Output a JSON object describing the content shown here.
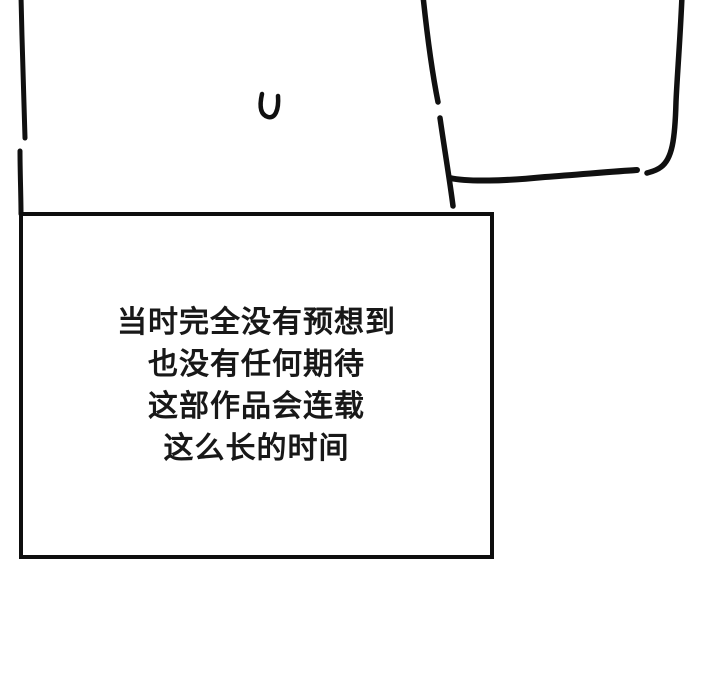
{
  "page": {
    "background_color": "#ffffff",
    "ink_color": "#101010"
  },
  "caption_box": {
    "border_color": "#0e0e0e",
    "text_color": "#181818",
    "lines": [
      "当时完全没有预想到",
      "也没有任何期待",
      "这部作品会连载",
      "这么长的时间"
    ]
  },
  "sketch": {
    "marks": [
      "left-panel-border-stroke-upper",
      "left-panel-border-stroke-lower",
      "u-mark",
      "panel-left-slant-stroke-upper",
      "panel-left-slant-stroke-lower",
      "panel-bottom-stroke",
      "panel-right-stroke"
    ]
  }
}
